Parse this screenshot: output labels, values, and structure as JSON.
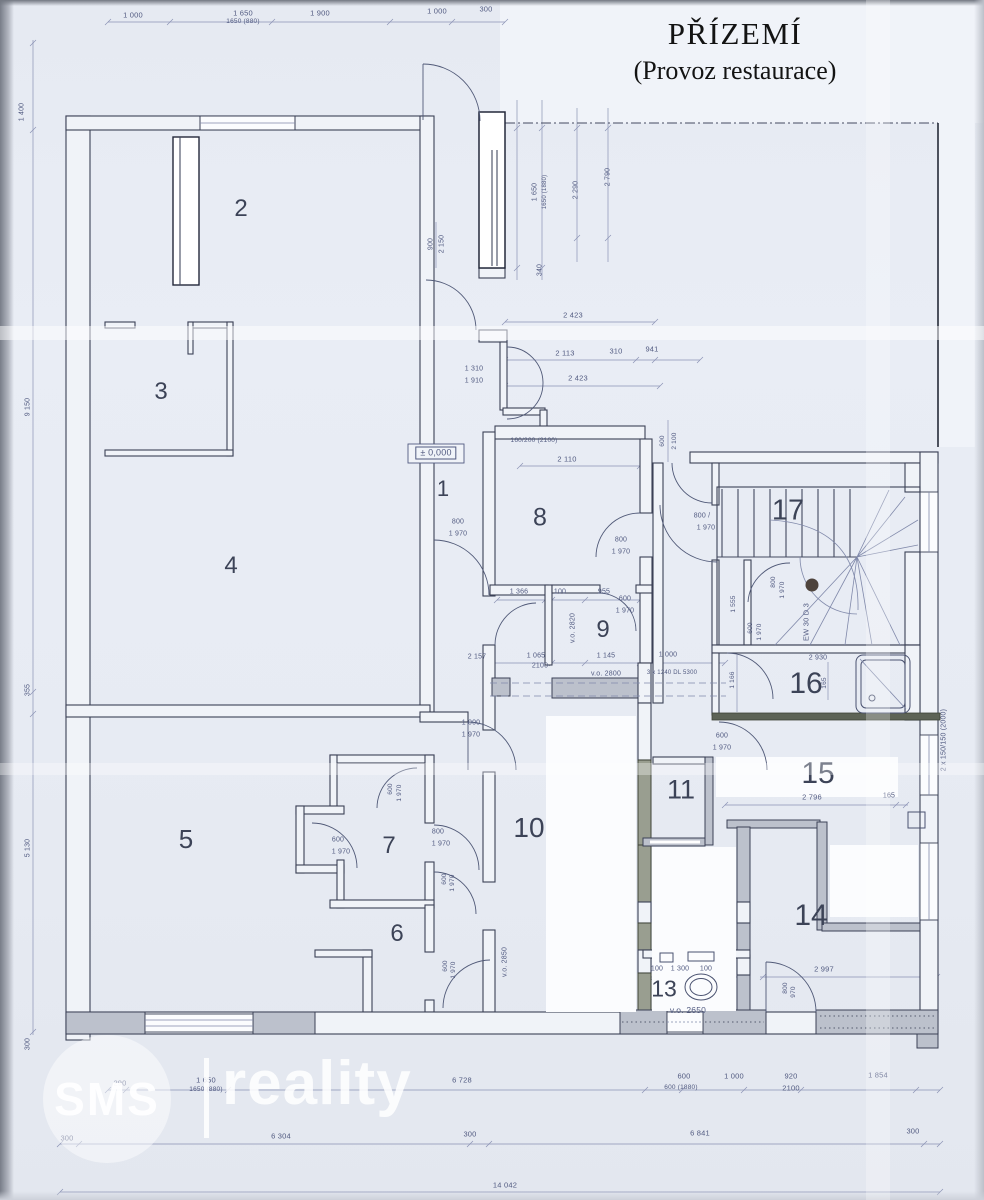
{
  "title": {
    "line1": "PŘÍZEMÍ",
    "line2": "(Provoz restaurace)"
  },
  "watermark": {
    "brand": "SMS",
    "name": "reality"
  },
  "colors": {
    "paper": "#e9edf5",
    "ink": "#3b4156",
    "dim": "#515a80",
    "wall_gray": "#bcc1cc",
    "wall_olive": "#999e90"
  },
  "rooms": [
    {
      "label": "1",
      "x": 443,
      "y": 489,
      "size": 22
    },
    {
      "label": "2",
      "x": 241,
      "y": 209,
      "size": 24
    },
    {
      "label": "3",
      "x": 161,
      "y": 392,
      "size": 24
    },
    {
      "label": "4",
      "x": 231,
      "y": 566,
      "size": 24
    },
    {
      "label": "5",
      "x": 186,
      "y": 839,
      "size": 26
    },
    {
      "label": "6",
      "x": 397,
      "y": 934,
      "size": 24
    },
    {
      "label": "7",
      "x": 389,
      "y": 846,
      "size": 24
    },
    {
      "label": "8",
      "x": 540,
      "y": 518,
      "size": 25
    },
    {
      "label": "9",
      "x": 603,
      "y": 630,
      "size": 24
    },
    {
      "label": "10",
      "x": 529,
      "y": 828,
      "size": 28
    },
    {
      "label": "11",
      "x": 681,
      "y": 790,
      "size": 27
    },
    {
      "label": "13",
      "x": 664,
      "y": 989,
      "size": 23
    },
    {
      "label": "14",
      "x": 811,
      "y": 916,
      "size": 30
    },
    {
      "label": "15",
      "x": 818,
      "y": 774,
      "size": 30
    },
    {
      "label": "16",
      "x": 806,
      "y": 684,
      "size": 30
    },
    {
      "label": "17",
      "x": 788,
      "y": 511,
      "size": 29
    }
  ],
  "dim_labels": [
    {
      "t": "1 000",
      "x": 133,
      "y": 15
    },
    {
      "t": "1 650",
      "x": 243,
      "y": 13
    },
    {
      "t": "1650 (880)",
      "x": 243,
      "y": 22,
      "s": 6.5
    },
    {
      "t": "1 900",
      "x": 320,
      "y": 13
    },
    {
      "t": "1 000",
      "x": 437,
      "y": 11
    },
    {
      "t": "300",
      "x": 486,
      "y": 9
    },
    {
      "t": "900",
      "x": 431,
      "y": 244,
      "r": -90,
      "s": 7
    },
    {
      "t": "2 150",
      "x": 442,
      "y": 244,
      "r": -90,
      "s": 7
    },
    {
      "t": "1 650",
      "x": 535,
      "y": 192,
      "r": -90,
      "s": 7
    },
    {
      "t": "1650 (1880)",
      "x": 545,
      "y": 192,
      "r": -90,
      "s": 6
    },
    {
      "t": "2 290",
      "x": 576,
      "y": 190,
      "r": -90,
      "s": 7
    },
    {
      "t": "2 790",
      "x": 608,
      "y": 177,
      "r": -90,
      "s": 7
    },
    {
      "t": "340",
      "x": 540,
      "y": 270,
      "r": -90,
      "s": 7
    },
    {
      "t": "1 400",
      "x": 22,
      "y": 112,
      "r": -90,
      "s": 7
    },
    {
      "t": "9 150",
      "x": 28,
      "y": 407,
      "r": -90,
      "s": 7
    },
    {
      "t": "355",
      "x": 28,
      "y": 690,
      "r": -90,
      "s": 7
    },
    {
      "t": "5 130",
      "x": 28,
      "y": 848,
      "r": -90,
      "s": 7
    },
    {
      "t": "300",
      "x": 28,
      "y": 1044,
      "r": -90,
      "s": 7
    },
    {
      "t": "2 423",
      "x": 573,
      "y": 315
    },
    {
      "t": "2 113",
      "x": 565,
      "y": 353
    },
    {
      "t": "310",
      "x": 616,
      "y": 351
    },
    {
      "t": "941",
      "x": 652,
      "y": 349
    },
    {
      "t": "1 310",
      "x": 474,
      "y": 369,
      "s": 7
    },
    {
      "t": "1 910",
      "x": 474,
      "y": 381,
      "s": 7
    },
    {
      "t": "2 423",
      "x": 578,
      "y": 378
    },
    {
      "t": "± 0,000",
      "x": 436,
      "y": 453,
      "s": 9,
      "b": true
    },
    {
      "t": "160/200 (2100)",
      "x": 534,
      "y": 441,
      "s": 6.5
    },
    {
      "t": "2 110",
      "x": 567,
      "y": 459
    },
    {
      "t": "800",
      "x": 458,
      "y": 522,
      "s": 7
    },
    {
      "t": "1 970",
      "x": 458,
      "y": 534,
      "s": 7
    },
    {
      "t": "800",
      "x": 621,
      "y": 540,
      "s": 7
    },
    {
      "t": "1 970",
      "x": 621,
      "y": 552,
      "s": 7
    },
    {
      "t": "600",
      "x": 625,
      "y": 599,
      "s": 7
    },
    {
      "t": "1 970",
      "x": 625,
      "y": 611,
      "s": 7
    },
    {
      "t": "1 366",
      "x": 519,
      "y": 592,
      "s": 7
    },
    {
      "t": "100",
      "x": 560,
      "y": 592,
      "s": 7
    },
    {
      "t": "955",
      "x": 604,
      "y": 592,
      "s": 7
    },
    {
      "t": "v.o. 2820",
      "x": 573,
      "y": 628,
      "r": -90,
      "s": 7
    },
    {
      "t": "2 157",
      "x": 477,
      "y": 657,
      "s": 7
    },
    {
      "t": "1 065",
      "x": 536,
      "y": 656,
      "s": 7
    },
    {
      "t": "2100",
      "x": 540,
      "y": 666,
      "s": 7
    },
    {
      "t": "1 145",
      "x": 606,
      "y": 656,
      "s": 7
    },
    {
      "t": "1 000",
      "x": 668,
      "y": 655,
      "s": 7
    },
    {
      "t": "v.o. 2800",
      "x": 606,
      "y": 674,
      "s": 7
    },
    {
      "t": "3 x 1240 DL 5300",
      "x": 672,
      "y": 673,
      "s": 6
    },
    {
      "t": "600",
      "x": 663,
      "y": 441,
      "r": -90,
      "s": 6.5
    },
    {
      "t": "2 100",
      "x": 675,
      "y": 441,
      "r": -90,
      "s": 6.5
    },
    {
      "t": "800 /",
      "x": 702,
      "y": 516,
      "s": 7
    },
    {
      "t": "1 970",
      "x": 706,
      "y": 528,
      "s": 7
    },
    {
      "t": "1 555",
      "x": 734,
      "y": 604,
      "r": -90,
      "s": 6.5
    },
    {
      "t": "800",
      "x": 774,
      "y": 582,
      "r": -90,
      "s": 6.5
    },
    {
      "t": "1 970",
      "x": 783,
      "y": 590,
      "r": -90,
      "s": 6.5
    },
    {
      "t": "EW 30 D 3",
      "x": 806,
      "y": 622,
      "r": -90,
      "s": 7.5
    },
    {
      "t": "600",
      "x": 751,
      "y": 628,
      "r": -90,
      "s": 6.5
    },
    {
      "t": "1 970",
      "x": 760,
      "y": 632,
      "r": -90,
      "s": 6.5
    },
    {
      "t": "2 930",
      "x": 818,
      "y": 658,
      "s": 7
    },
    {
      "t": "1 166",
      "x": 733,
      "y": 680,
      "r": -90,
      "s": 6.5
    },
    {
      "t": "165",
      "x": 825,
      "y": 683,
      "r": -90,
      "s": 6.5
    },
    {
      "t": "2 x 150/150 (2000)",
      "x": 944,
      "y": 740,
      "r": -90,
      "s": 7
    },
    {
      "t": "600",
      "x": 722,
      "y": 736,
      "s": 7
    },
    {
      "t": "1 970",
      "x": 722,
      "y": 748,
      "s": 7
    },
    {
      "t": "2 796",
      "x": 812,
      "y": 797
    },
    {
      "t": "165",
      "x": 889,
      "y": 796,
      "s": 7
    },
    {
      "t": "1 000",
      "x": 471,
      "y": 723,
      "s": 7
    },
    {
      "t": "1 970",
      "x": 471,
      "y": 735,
      "s": 7
    },
    {
      "t": "600",
      "x": 391,
      "y": 789,
      "r": -90,
      "s": 6.5
    },
    {
      "t": "1 970",
      "x": 400,
      "y": 793,
      "r": -90,
      "s": 6.5
    },
    {
      "t": "600",
      "x": 338,
      "y": 840,
      "s": 7
    },
    {
      "t": "1 970",
      "x": 341,
      "y": 852,
      "s": 7
    },
    {
      "t": "800",
      "x": 438,
      "y": 832,
      "s": 7
    },
    {
      "t": "1 970",
      "x": 441,
      "y": 844,
      "s": 7
    },
    {
      "t": "600",
      "x": 445,
      "y": 879,
      "r": -90,
      "s": 6.5
    },
    {
      "t": "1 970",
      "x": 453,
      "y": 883,
      "r": -90,
      "s": 6.5
    },
    {
      "t": "600",
      "x": 446,
      "y": 966,
      "r": -90,
      "s": 6.5
    },
    {
      "t": "1 970",
      "x": 454,
      "y": 970,
      "r": -90,
      "s": 6.5
    },
    {
      "t": "v.o. 2850",
      "x": 505,
      "y": 962,
      "r": -90,
      "s": 7
    },
    {
      "t": "100",
      "x": 657,
      "y": 969,
      "s": 7
    },
    {
      "t": "1 300",
      "x": 680,
      "y": 969,
      "s": 7
    },
    {
      "t": "100",
      "x": 706,
      "y": 969,
      "s": 7
    },
    {
      "t": "v.o. 2650",
      "x": 688,
      "y": 1010,
      "s": 8.5
    },
    {
      "t": "2 997",
      "x": 824,
      "y": 969
    },
    {
      "t": "800",
      "x": 786,
      "y": 988,
      "r": -90,
      "s": 6.5
    },
    {
      "t": "970",
      "x": 794,
      "y": 992,
      "r": -90,
      "s": 6.5
    },
    {
      "t": "290",
      "x": 120,
      "y": 1083
    },
    {
      "t": "1 650",
      "x": 206,
      "y": 1080
    },
    {
      "t": "1650 (880)",
      "x": 206,
      "y": 1090,
      "s": 6.5
    },
    {
      "t": "6 728",
      "x": 462,
      "y": 1080
    },
    {
      "t": "600",
      "x": 684,
      "y": 1076
    },
    {
      "t": "600 (1880)",
      "x": 681,
      "y": 1088,
      "s": 6.5
    },
    {
      "t": "1 000",
      "x": 734,
      "y": 1076
    },
    {
      "t": "920",
      "x": 791,
      "y": 1076
    },
    {
      "t": "2100",
      "x": 791,
      "y": 1088
    },
    {
      "t": "1 854",
      "x": 878,
      "y": 1075
    },
    {
      "t": "300",
      "x": 67,
      "y": 1138
    },
    {
      "t": "6 304",
      "x": 281,
      "y": 1136
    },
    {
      "t": "300",
      "x": 470,
      "y": 1134
    },
    {
      "t": "6 841",
      "x": 700,
      "y": 1133
    },
    {
      "t": "300",
      "x": 913,
      "y": 1131
    },
    {
      "t": "14 042",
      "x": 505,
      "y": 1185
    }
  ]
}
